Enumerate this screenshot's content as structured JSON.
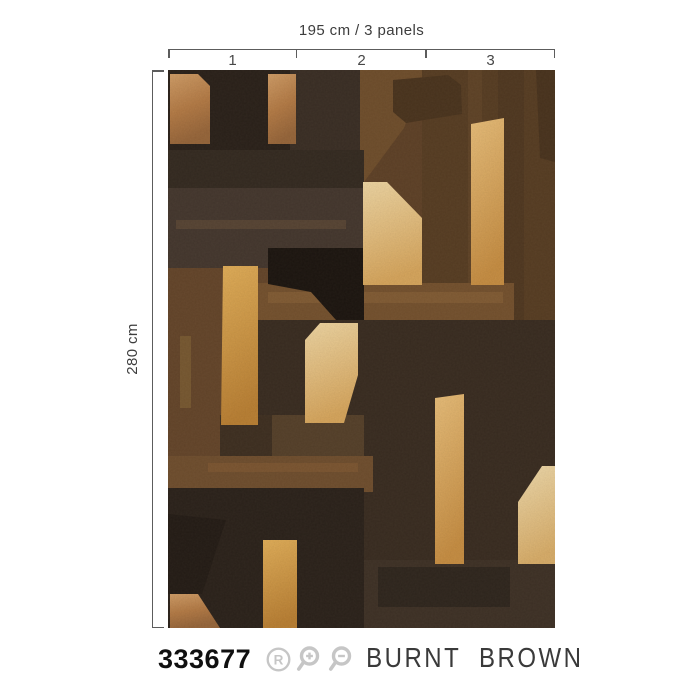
{
  "measurements": {
    "width_label": "195 cm / 3 panels",
    "height_label": "280 cm",
    "panels": [
      "1",
      "2",
      "3"
    ]
  },
  "product": {
    "sku": "333677",
    "name": "BURNT BROWN"
  },
  "icons": {
    "repeat_badge": "R"
  },
  "palette": {
    "page_bg": "#ffffff",
    "measure_line": "#5c5c5c",
    "measure_text": "#3d3d3d",
    "sku_text": "#101010",
    "name_text": "#3a3a3a",
    "icon_gray": "#c6c6c6",
    "base_brown": "#5E4127",
    "gold": "#d2a35f",
    "dark_brown": "#2A211A"
  },
  "wallpaper": {
    "description": "Burnt Brown abstract geometric patchwork mural in browns and gold",
    "shapes": [
      {
        "name": "base",
        "rect": [
          0,
          0,
          387,
          558
        ],
        "fill": "#5E4127"
      },
      {
        "name": "top-left-dark",
        "rect": [
          0,
          0,
          196,
          80
        ],
        "fill": "#2A211A"
      },
      {
        "name": "dark-column",
        "rect": [
          122,
          0,
          70,
          198
        ],
        "fill": "#3A2E25"
      },
      {
        "name": "brown-trapezoid",
        "points": "192,0 258,0 236,58 196,112 192,112",
        "fill": "#6F4E2C"
      },
      {
        "name": "right-column",
        "rect": [
          254,
          0,
          133,
          312
        ],
        "fill": "#573D23"
      },
      {
        "name": "right-column-streak-dark",
        "rect": [
          330,
          0,
          26,
          300
        ],
        "fill": "#4A3420",
        "opacity": 0.55
      },
      {
        "name": "right-column-streak-light",
        "rect": [
          300,
          0,
          14,
          290
        ],
        "fill": "#6B4C2C",
        "opacity": 0.45
      },
      {
        "name": "top-right-corner",
        "points": "368,0 387,0 387,92 372,88",
        "fill": "#49331E"
      },
      {
        "name": "dark-band-1",
        "rect": [
          0,
          80,
          196,
          38
        ],
        "fill": "#342A21"
      },
      {
        "name": "dark-band-2",
        "rect": [
          0,
          118,
          202,
          80
        ],
        "fill": "#44372E"
      },
      {
        "name": "band-streak",
        "rect": [
          8,
          150,
          170,
          9
        ],
        "fill": "#6A523A",
        "opacity": 0.5
      },
      {
        "name": "left-brown",
        "rect": [
          0,
          198,
          124,
          262
        ],
        "fill": "#64452A"
      },
      {
        "name": "left-gold-streak",
        "rect": [
          12,
          266,
          11,
          72
        ],
        "fill": "#9C7A3E",
        "opacity": 0.35
      },
      {
        "name": "center-band",
        "rect": [
          88,
          213,
          258,
          40
        ],
        "fill": "#74512E"
      },
      {
        "name": "center-band-streak",
        "rect": [
          100,
          222,
          235,
          11
        ],
        "fill": "#8A6238",
        "opacity": 0.6
      },
      {
        "name": "dark-center",
        "rect": [
          88,
          250,
          299,
          240
        ],
        "fill": "#392C21"
      },
      {
        "name": "black-polygon",
        "points": "100,178 196,178 196,250 168,250 143,222 100,214",
        "fill": "#1C1510"
      },
      {
        "name": "mid-left-patch",
        "rect": [
          52,
          345,
          144,
          42
        ],
        "fill": "#55402A"
      },
      {
        "name": "mid-left-patch-dark",
        "rect": [
          52,
          345,
          52,
          42
        ],
        "fill": "#3B2D20",
        "opacity": 0.85
      },
      {
        "name": "lower-brown-band",
        "rect": [
          0,
          386,
          205,
          36
        ],
        "fill": "#6F4E2E"
      },
      {
        "name": "lower-band-streak",
        "rect": [
          40,
          393,
          150,
          9
        ],
        "fill": "#8A6035",
        "opacity": 0.45
      },
      {
        "name": "bottom-left-dark",
        "rect": [
          0,
          418,
          196,
          140
        ],
        "fill": "#2B221B"
      },
      {
        "name": "bottom-left-black",
        "points": "0,444 58,450 34,524 0,524",
        "fill": "#241C16"
      },
      {
        "name": "bottom-band-right",
        "rect": [
          196,
          490,
          191,
          68
        ],
        "fill": "#3E3126"
      },
      {
        "name": "bottom-band-inner",
        "rect": [
          210,
          497,
          132,
          40
        ],
        "fill": "#2F261E"
      },
      {
        "name": "gold-top-left",
        "points": "2,4 30,4 42,16 42,74 2,74",
        "fill": "url(#gCopper)"
      },
      {
        "name": "gold-strip-top",
        "rect": [
          100,
          4,
          28,
          70
        ],
        "fill": "url(#gCopper)"
      },
      {
        "name": "dark-chamfer-block",
        "points": "225,10 280,5 293,15 294,44 238,53 225,42",
        "fill": "#4A341E"
      },
      {
        "name": "gold-strip-right-upper",
        "points": "303,54 336,48 336,215 303,215",
        "fill": "url(#gGoldBright)"
      },
      {
        "name": "gold-pentagon-center-upper",
        "points": "195,112 219,112 254,148 254,215 195,215",
        "fill": "url(#gCream)"
      },
      {
        "name": "gold-strip-left",
        "points": "55,196 90,196 90,355 53,355",
        "fill": "url(#gGoldL)"
      },
      {
        "name": "gold-pentagon-center",
        "points": "137,270 152,253 190,253 190,305 176,353 137,353",
        "fill": "url(#gCream)"
      },
      {
        "name": "gold-strip-center-lower",
        "points": "267,328 296,324 296,494 267,494",
        "fill": "url(#gGoldBright)"
      },
      {
        "name": "gold-pentagon-right",
        "points": "350,432 374,396 387,396 387,494 350,494",
        "fill": "url(#gCreamR)"
      },
      {
        "name": "gold-strip-bottom-left",
        "rect": [
          95,
          470,
          34,
          88
        ],
        "fill": "url(#gGoldL)"
      },
      {
        "name": "gold-wedge-bottom",
        "points": "2,524 30,524 52,558 2,558",
        "fill": "url(#gCopper)"
      }
    ]
  }
}
